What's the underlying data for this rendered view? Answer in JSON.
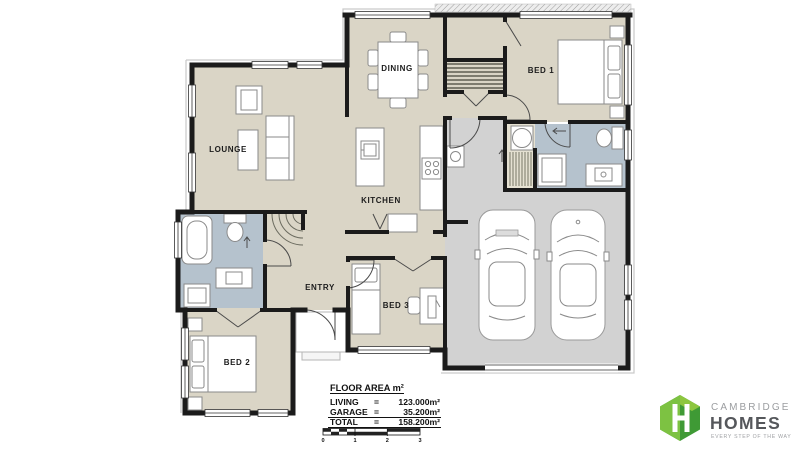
{
  "rooms": {
    "lounge": "LOUNGE",
    "dining": "DINING",
    "kitchen": "KITCHEN",
    "entry": "ENTRY",
    "bed1": "BED 1",
    "bed2": "BED 2",
    "bed3": "BED 3"
  },
  "floor_area": {
    "heading": "FLOOR AREA m²",
    "rows": [
      {
        "label": "LIVING",
        "eq": "=",
        "value": "123.000m²"
      },
      {
        "label": "GARAGE",
        "eq": "=",
        "value": "35.200m²"
      },
      {
        "label": "TOTAL",
        "eq": "=",
        "value": "158.200m²"
      }
    ],
    "scale": [
      "0",
      "1",
      "2",
      "3"
    ]
  },
  "logo": {
    "brand_top": "CAMBRIDGE",
    "brand_bottom": "HOMES",
    "tagline": "EVERY STEP OF THE WAY"
  },
  "colors": {
    "floor": "#dad5c6",
    "wet": "#b5c2cd",
    "garage": "#d2d2d2",
    "cupboard": "#e5e1d2",
    "wall": "#1b1b1b",
    "logo_light": "#7dc242",
    "logo_dark": "#3f9a35"
  }
}
